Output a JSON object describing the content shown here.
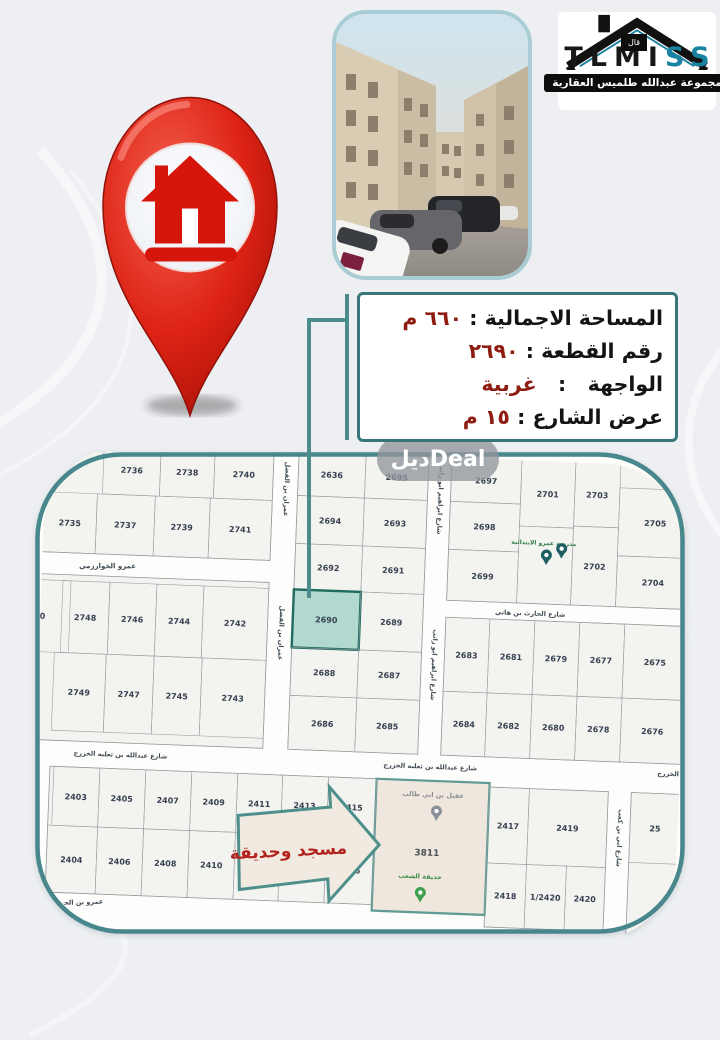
{
  "logo": {
    "brand_black": "TLMI",
    "brand_teal": "SS",
    "roof_label": "قال",
    "tagline": "مجموعة عبدالله طلميس العقارية"
  },
  "info_box": {
    "lines": [
      {
        "label": "المساحة الاجمالية",
        "value": "٦٦٠ م"
      },
      {
        "label": "رقم القطعة",
        "value": "٢٦٩٠"
      },
      {
        "label": "الواجهة",
        "value": "غربية"
      },
      {
        "label": "عرض الشارع",
        "value": "١٥ م"
      }
    ]
  },
  "watermark": "ديلDeal",
  "colors": {
    "accent_teal": "#48878c",
    "pin_red": "#d6150b",
    "value_red": "#8e1c11"
  },
  "map": {
    "bg": "#fdfdfb",
    "block_fill": "#f3f3f0",
    "block_stroke": "#8f969c",
    "cell_stroke": "#9aa1a7",
    "number_color": "#374151",
    "street_label_color": "#3f4a54",
    "border_color": "#48878c",
    "rotation": 2.2,
    "highlight": {
      "fill": "#b2d9d0",
      "stroke": "#206b60"
    },
    "blocks": [
      {
        "x": 0,
        "y": 0,
        "w": 230,
        "h": 112
      },
      {
        "x": 0,
        "y": 134,
        "w": 230,
        "h": 166
      },
      {
        "x": 255,
        "y": 0,
        "w": 130,
        "h": 300
      },
      {
        "x": 408,
        "y": 0,
        "w": 242,
        "h": 145
      },
      {
        "x": 408,
        "y": 162,
        "w": 242,
        "h": 138
      },
      {
        "x": 18,
        "y": 326,
        "w": 327,
        "h": 126
      },
      {
        "x": 458,
        "y": 330,
        "w": 119,
        "h": 140
      },
      {
        "x": 600,
        "y": 330,
        "w": 50,
        "h": 148
      }
    ],
    "mosque_block": {
      "x": 345,
      "y": 326,
      "w": 113,
      "h": 132,
      "fill": "#efe7dd",
      "stroke": "#5f9a94"
    },
    "plots": [
      {
        "n": "2736",
        "x": 60,
        "y": 2,
        "w": 57,
        "h": 50
      },
      {
        "n": "2738",
        "x": 117,
        "y": 2,
        "w": 54,
        "h": 50
      },
      {
        "n": "2740",
        "x": 171,
        "y": 2,
        "w": 59,
        "h": 50
      },
      {
        "n": "2735",
        "x": 2,
        "y": 52,
        "w": 53,
        "h": 60
      },
      {
        "n": "2737",
        "x": 55,
        "y": 52,
        "w": 58,
        "h": 60
      },
      {
        "n": "2739",
        "x": 113,
        "y": 52,
        "w": 55,
        "h": 60
      },
      {
        "n": "2741",
        "x": 168,
        "y": 52,
        "w": 62,
        "h": 60
      },
      {
        "n": "50",
        "x": -28,
        "y": 140,
        "w": 60,
        "h": 72
      },
      {
        "n": "2748",
        "x": 24,
        "y": 140,
        "w": 47,
        "h": 72
      },
      {
        "n": "2746",
        "x": 71,
        "y": 140,
        "w": 47,
        "h": 72
      },
      {
        "n": "2744",
        "x": 118,
        "y": 140,
        "w": 47,
        "h": 72
      },
      {
        "n": "2742",
        "x": 165,
        "y": 140,
        "w": 65,
        "h": 72
      },
      {
        "n": "2749",
        "x": 18,
        "y": 212,
        "w": 52,
        "h": 78
      },
      {
        "n": "2747",
        "x": 70,
        "y": 212,
        "w": 48,
        "h": 78
      },
      {
        "n": "2745",
        "x": 118,
        "y": 212,
        "w": 48,
        "h": 78
      },
      {
        "n": "2743",
        "x": 166,
        "y": 212,
        "w": 64,
        "h": 78
      },
      {
        "n": "2636",
        "x": 255,
        "y": 2,
        "w": 67,
        "h": 44
      },
      {
        "n": "2695",
        "x": 322,
        "y": 2,
        "w": 63,
        "h": 44
      },
      {
        "n": "2694",
        "x": 255,
        "y": 46,
        "w": 67,
        "h": 48
      },
      {
        "n": "2693",
        "x": 322,
        "y": 46,
        "w": 63,
        "h": 48
      },
      {
        "n": "2692",
        "x": 255,
        "y": 94,
        "w": 67,
        "h": 46
      },
      {
        "n": "2691",
        "x": 322,
        "y": 94,
        "w": 63,
        "h": 46
      },
      {
        "n": "2690",
        "x": 255,
        "y": 140,
        "w": 67,
        "h": 58,
        "hl": true
      },
      {
        "n": "2689",
        "x": 322,
        "y": 140,
        "w": 63,
        "h": 58
      },
      {
        "n": "2688",
        "x": 255,
        "y": 198,
        "w": 67,
        "h": 48
      },
      {
        "n": "2687",
        "x": 322,
        "y": 198,
        "w": 63,
        "h": 48
      },
      {
        "n": "2686",
        "x": 255,
        "y": 246,
        "w": 67,
        "h": 54
      },
      {
        "n": "2685",
        "x": 322,
        "y": 246,
        "w": 63,
        "h": 54
      },
      {
        "n": "2697",
        "x": 408,
        "y": 2,
        "w": 70,
        "h": 44
      },
      {
        "n": "2698",
        "x": 408,
        "y": 46,
        "w": 70,
        "h": 48
      },
      {
        "n": "2699",
        "x": 408,
        "y": 94,
        "w": 70,
        "h": 51
      },
      {
        "n": "2701",
        "x": 478,
        "y": 2,
        "w": 54,
        "h": 66
      },
      {
        "n": "",
        "x": 478,
        "y": 68,
        "w": 54,
        "h": 77
      },
      {
        "n": "2703",
        "x": 532,
        "y": 2,
        "w": 45,
        "h": 64
      },
      {
        "n": "2702",
        "x": 532,
        "y": 66,
        "w": 45,
        "h": 79
      },
      {
        "n": "2705",
        "x": 577,
        "y": 26,
        "w": 73,
        "h": 68
      },
      {
        "n": "2704",
        "x": 577,
        "y": 94,
        "w": 73,
        "h": 51
      },
      {
        "n": "2683",
        "x": 408,
        "y": 162,
        "w": 44,
        "h": 74
      },
      {
        "n": "2681",
        "x": 452,
        "y": 162,
        "w": 45,
        "h": 74
      },
      {
        "n": "2679",
        "x": 497,
        "y": 162,
        "w": 45,
        "h": 74
      },
      {
        "n": "2677",
        "x": 542,
        "y": 162,
        "w": 45,
        "h": 74
      },
      {
        "n": "2675",
        "x": 587,
        "y": 162,
        "w": 63,
        "h": 74
      },
      {
        "n": "2684",
        "x": 408,
        "y": 236,
        "w": 44,
        "h": 64
      },
      {
        "n": "2682",
        "x": 452,
        "y": 236,
        "w": 45,
        "h": 64
      },
      {
        "n": "2680",
        "x": 497,
        "y": 236,
        "w": 45,
        "h": 64
      },
      {
        "n": "2678",
        "x": 542,
        "y": 236,
        "w": 45,
        "h": 64
      },
      {
        "n": "2676",
        "x": 587,
        "y": 236,
        "w": 63,
        "h": 64
      },
      {
        "n": "2403",
        "x": 22,
        "y": 326,
        "w": 46,
        "h": 59
      },
      {
        "n": "2405",
        "x": 68,
        "y": 326,
        "w": 46,
        "h": 59
      },
      {
        "n": "2407",
        "x": 114,
        "y": 326,
        "w": 46,
        "h": 59
      },
      {
        "n": "2409",
        "x": 160,
        "y": 326,
        "w": 46,
        "h": 59
      },
      {
        "n": "2411",
        "x": 206,
        "y": 326,
        "w": 45,
        "h": 59
      },
      {
        "n": "2413",
        "x": 251,
        "y": 326,
        "w": 46,
        "h": 59
      },
      {
        "n": "2415",
        "x": 297,
        "y": 326,
        "w": 48,
        "h": 59
      },
      {
        "n": "2404",
        "x": 18,
        "y": 385,
        "w": 50,
        "h": 67
      },
      {
        "n": "2406",
        "x": 68,
        "y": 385,
        "w": 46,
        "h": 67
      },
      {
        "n": "2408",
        "x": 114,
        "y": 385,
        "w": 46,
        "h": 67
      },
      {
        "n": "2410",
        "x": 160,
        "y": 385,
        "w": 46,
        "h": 67
      },
      {
        "n": "2412",
        "x": 206,
        "y": 385,
        "w": 45,
        "h": 67
      },
      {
        "n": "2414",
        "x": 251,
        "y": 385,
        "w": 46,
        "h": 67
      },
      {
        "n": "2416",
        "x": 297,
        "y": 385,
        "w": 48,
        "h": 67
      },
      {
        "n": "2417",
        "x": 458,
        "y": 330,
        "w": 40,
        "h": 76
      },
      {
        "n": "2419",
        "x": 498,
        "y": 330,
        "w": 79,
        "h": 76
      },
      {
        "n": "2418",
        "x": 458,
        "y": 406,
        "w": 40,
        "h": 64
      },
      {
        "n": "1/2420",
        "x": 498,
        "y": 406,
        "w": 40,
        "h": 64
      },
      {
        "n": "2420",
        "x": 538,
        "y": 406,
        "w": 39,
        "h": 64
      },
      {
        "n": "25",
        "x": 600,
        "y": 330,
        "w": 50,
        "h": 70
      }
    ],
    "street_labels": [
      {
        "t": "عمران بن الفضل",
        "x": 242,
        "y": 40,
        "r": 90,
        "s": 6.5
      },
      {
        "t": "عمران بن الفضل",
        "x": 242,
        "y": 184,
        "r": 90,
        "s": 6.5
      },
      {
        "t": "شارع ابراهيم ابو راتب",
        "x": 396,
        "y": 44,
        "r": 90,
        "s": 6.5
      },
      {
        "t": "شارع ابراهيم ابو راتب",
        "x": 396,
        "y": 210,
        "r": 90,
        "s": 6.5
      },
      {
        "t": "شارع ابي بن كعب",
        "x": 588,
        "y": 376,
        "r": 90,
        "s": 6.5
      },
      {
        "t": "عمرو الخوارزمي",
        "x": 68,
        "y": 126,
        "r": -2,
        "s": 7
      },
      {
        "t": "شارع الحارث بن هاني",
        "x": 492,
        "y": 157,
        "r": 0,
        "s": 6.5
      },
      {
        "t": "شارع عبدالله بن ثعلبه الخزرج",
        "x": 88,
        "y": 314,
        "r": 0,
        "s": 6.5
      },
      {
        "t": "شارع عبدالله بن ثعلبه الخزرج",
        "x": 398,
        "y": 314,
        "r": 0,
        "s": 6.5
      },
      {
        "t": "الخزرج",
        "x": 636,
        "y": 312,
        "r": 0,
        "s": 6.5
      },
      {
        "t": "عمرو بن الحمق",
        "x": 52,
        "y": 463,
        "r": -4,
        "s": 6.5
      }
    ],
    "pois": [
      {
        "t": "مدرسة عمرو الابتدائية",
        "x": 503,
        "y": 86,
        "c": "#2f7d46",
        "s": 6
      },
      {
        "t": "عقيل بن ابي طالب",
        "x": 402,
        "y": 342,
        "c": "#8a8f94",
        "s": 6.5
      },
      {
        "t": "3811",
        "x": 398,
        "y": 401,
        "c": "#4a5158",
        "s": 9
      },
      {
        "t": "حديقة الشعب",
        "x": 392,
        "y": 424,
        "c": "#3c8b49",
        "s": 6.5
      }
    ],
    "pins": [
      {
        "x": 506,
        "y": 104,
        "c": "#1e5f63"
      },
      {
        "x": 521,
        "y": 97,
        "c": "#1e5f63"
      },
      {
        "x": 406,
        "y": 364,
        "c": "#8a9097"
      },
      {
        "x": 393,
        "y": 446,
        "c": "#3f9d4e"
      }
    ],
    "arrow": {
      "points": "208,368 300,356 298,336 350,392 302,450 300,428 212,442",
      "fill": "#f1eae1",
      "stroke": "#4e8f8c",
      "label": "مسجد وحديقة",
      "lx": 260,
      "ly": 407,
      "lr": -5,
      "lc": "#b3231d",
      "ls": 17
    }
  }
}
